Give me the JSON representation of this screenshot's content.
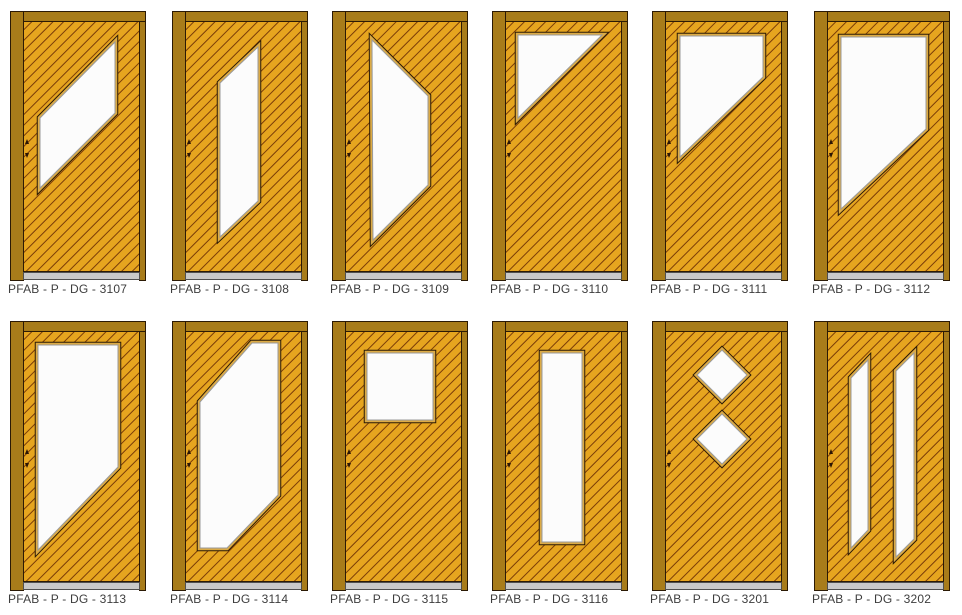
{
  "sheet": {
    "background": "#ffffff",
    "rows": 2,
    "columns": 6
  },
  "palette": {
    "frame": "#a87c1a",
    "leaf": "#e6a51f",
    "hatch_line": "#7a3c08",
    "outline": "#2b1a05",
    "glass": "#fcfcfc",
    "bead": "#dcab45",
    "glass_inner_line": "#9a9a9a",
    "threshold": "#c9c9c9",
    "threshold_edge": "#4f4f4f",
    "hinge_mark": "#2a1505",
    "label_text": "#3d3d3d"
  },
  "door_geometry": {
    "cell_w": 136,
    "cell_h": 270,
    "rail_h": 10,
    "post_w": 13,
    "right_strip_w": 7,
    "leaf": {
      "x": 13,
      "y": 10,
      "w": 117,
      "h": 251
    },
    "threshold_h": 8,
    "hatch_spacing": 7.5,
    "col_x": [
      10,
      172,
      332,
      492,
      652,
      814
    ],
    "row_y": [
      11,
      321
    ]
  },
  "doors": [
    {
      "id": "3107",
      "label": "PFAB - P - DG - 3107",
      "glass": [
        [
          [
            105,
            31
          ],
          [
            105,
            102
          ],
          [
            30,
            177
          ],
          [
            30,
            107
          ]
        ]
      ]
    },
    {
      "id": "3108",
      "label": "PFAB - P - DG - 3108",
      "glass": [
        [
          [
            86,
            36
          ],
          [
            86,
            190
          ],
          [
            48,
            226
          ],
          [
            48,
            72
          ]
        ]
      ]
    },
    {
      "id": "3109",
      "label": "PFAB - P - DG - 3109",
      "glass": [
        [
          [
            40,
            29
          ],
          [
            96,
            85
          ],
          [
            96,
            174
          ],
          [
            41,
            229
          ]
        ]
      ]
    },
    {
      "id": "3110",
      "label": "PFAB - P - DG - 3110",
      "glass": [
        [
          [
            26,
            24
          ],
          [
            110,
            24
          ],
          [
            26,
            107
          ]
        ]
      ]
    },
    {
      "id": "3111",
      "label": "PFAB - P - DG - 3111",
      "glass": [
        [
          [
            28,
            25
          ],
          [
            111,
            25
          ],
          [
            111,
            66
          ],
          [
            28,
            146
          ]
        ]
      ]
    },
    {
      "id": "3112",
      "label": "PFAB - P - DG - 3112",
      "glass": [
        [
          [
            27,
            26
          ],
          [
            112,
            26
          ],
          [
            112,
            118
          ],
          [
            27,
            198
          ]
        ]
      ]
    },
    {
      "id": "3113",
      "label": "PFAB - P - DG - 3113",
      "glass": [
        [
          [
            28,
            24
          ],
          [
            108,
            24
          ],
          [
            108,
            146
          ],
          [
            28,
            229
          ]
        ]
      ]
    },
    {
      "id": "3114",
      "label": "PFAB - P - DG - 3114",
      "glass": [
        [
          [
            80,
            22
          ],
          [
            106,
            22
          ],
          [
            106,
            174
          ],
          [
            55,
            227
          ],
          [
            28,
            227
          ],
          [
            28,
            81
          ]
        ]
      ]
    },
    {
      "id": "3115",
      "label": "PFAB - P - DG - 3115",
      "glass": [
        [
          [
            35,
            32
          ],
          [
            101,
            32
          ],
          [
            101,
            99
          ],
          [
            35,
            99
          ]
        ]
      ]
    },
    {
      "id": "3116",
      "label": "PFAB - P - DG - 3116",
      "glass": [
        [
          [
            50,
            32
          ],
          [
            90,
            32
          ],
          [
            90,
            221
          ],
          [
            50,
            221
          ]
        ]
      ]
    },
    {
      "id": "3201",
      "label": "PFAB - P - DG - 3201",
      "glass": [
        [
          [
            70,
            29
          ],
          [
            95,
            54
          ],
          [
            70,
            79
          ],
          [
            45,
            54
          ]
        ],
        [
          [
            70,
            93
          ],
          [
            95,
            118
          ],
          [
            70,
            143
          ],
          [
            45,
            118
          ]
        ]
      ]
    },
    {
      "id": "3202",
      "label": "PFAB - P - DG - 3202",
      "glass": [
        [
          [
            37,
            57
          ],
          [
            54,
            39
          ],
          [
            54,
            209
          ],
          [
            37,
            227
          ]
        ],
        [
          [
            82,
            50
          ],
          [
            100,
            32
          ],
          [
            100,
            218
          ],
          [
            82,
            236
          ]
        ]
      ]
    }
  ]
}
